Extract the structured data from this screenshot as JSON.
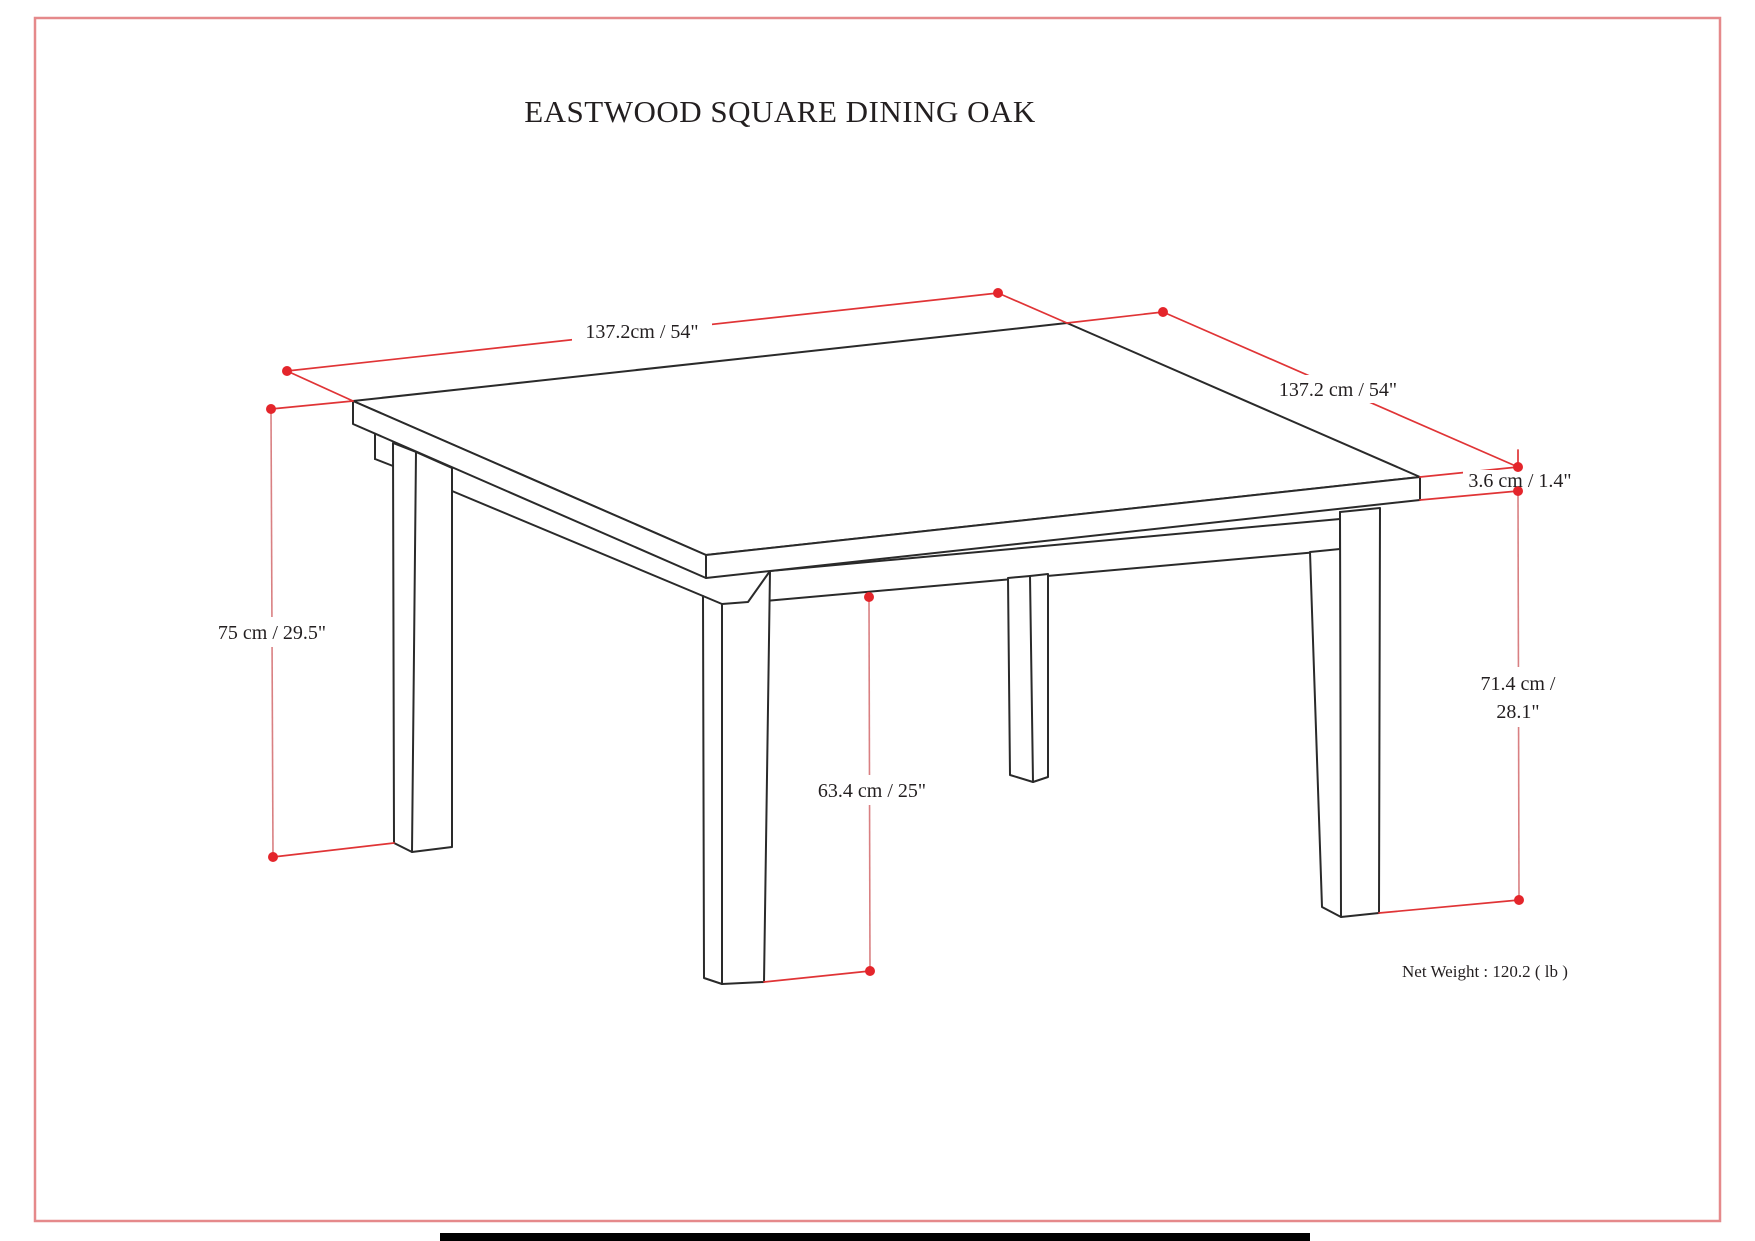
{
  "title": "EASTWOOD SQUARE DINING OAK",
  "dimensions": {
    "width_left": "137.2cm / 54\"",
    "width_right": "137.2 cm / 54\"",
    "top_thickness": "3.6 cm / 1.4\"",
    "overall_height": "75 cm / 29.5\"",
    "clearance_height": "63.4 cm / 25\"",
    "leg_height_line1": "71.4 cm /",
    "leg_height_line2": "28.1\""
  },
  "net_weight": "Net Weight : 120.2 ( lb )",
  "colors": {
    "dimension_line": "#e03436",
    "dimension_line_light": "#d98082",
    "dimension_dot": "#e4252b",
    "page_border": "#e5898b",
    "ink": "#2a2a2a",
    "text": "#231f20"
  }
}
